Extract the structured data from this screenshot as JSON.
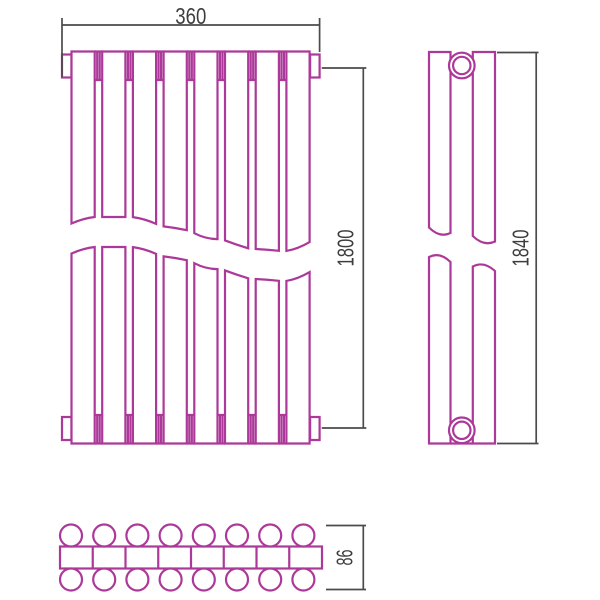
{
  "drawing": {
    "type": "technical-drawing",
    "subject": "tubular-radiator-orthographic-views",
    "dimensions": {
      "front_width": "360",
      "front_height": "1800",
      "side_height": "1840",
      "depth": "86"
    },
    "views": {
      "front": {
        "tube_count": 8,
        "collector_joints": 7,
        "end_tabs": 4
      },
      "side": {
        "tube_count": 2,
        "fitting_circles": 2
      },
      "plan": {
        "sections": 8,
        "tube_rows": 2,
        "tubes_per_row": 8
      }
    },
    "colors": {
      "outline": "#ac3999",
      "dimension_lines": "#4b4b4b",
      "text": "#3d3d3d",
      "background": "#ffffff"
    }
  }
}
